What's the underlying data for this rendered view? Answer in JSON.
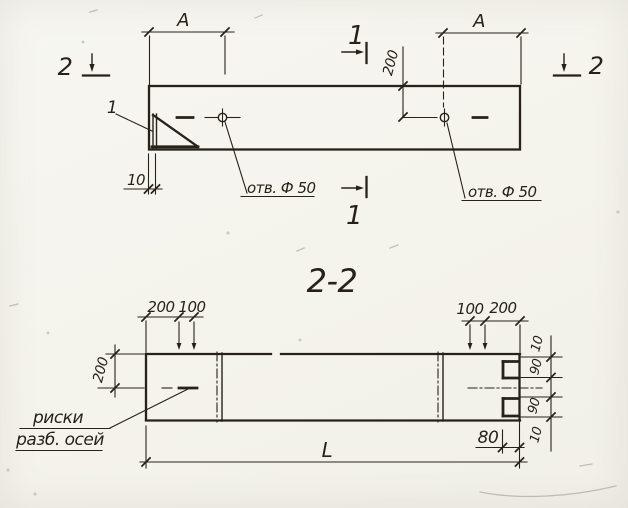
{
  "colors": {
    "paper": "#f5f4ee",
    "ink": "#262219"
  },
  "plan_view": {
    "dim_span_left": "А",
    "dim_span_right": "А",
    "dim_hole_offset": "200",
    "dim_end_wall": "10",
    "hole_note_left": "отв. Ф 50",
    "hole_note_right": "отв. Ф 50",
    "detail_mark": "1",
    "cut_1_top": "1",
    "cut_1_bottom": "1",
    "cut_2_left": "2",
    "cut_2_right": "2"
  },
  "section_view": {
    "title": "2-2",
    "dim_half_width": "200",
    "top_left_dims": [
      "200",
      "100"
    ],
    "top_right_dims": [
      "100",
      "200"
    ],
    "right_chain_dims": [
      "10",
      "90",
      "90",
      "10"
    ],
    "dim_notch_depth": "80",
    "dim_overall_length": "L",
    "axis_note_line1": "риски",
    "axis_note_line2": "разб. осей"
  }
}
